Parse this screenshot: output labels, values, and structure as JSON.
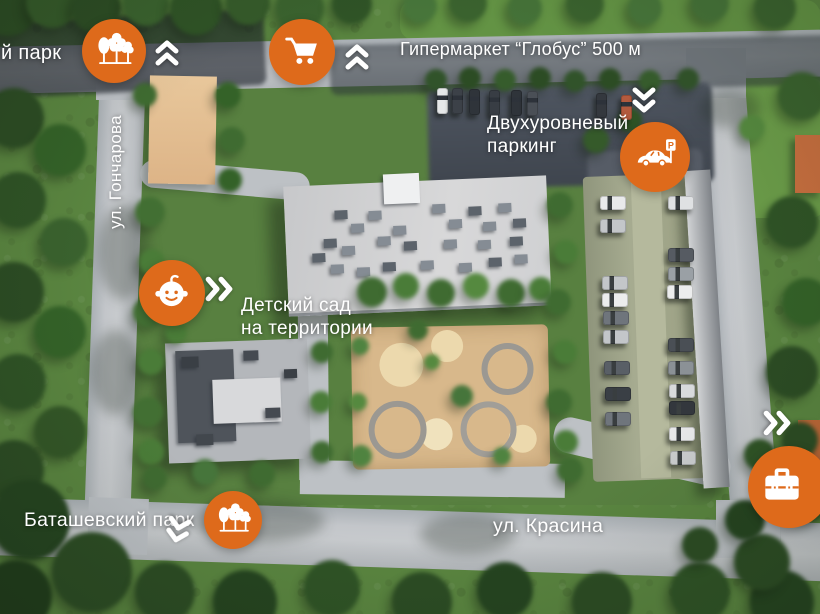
{
  "labels": {
    "park_top": "й парк",
    "hypermarket": "Гипермаркет “Глобус” 500 м",
    "parking_l1": "Двухуровневый",
    "parking_l2": "паркинг",
    "kindergarten_l1": "Детский сад",
    "kindergarten_l2": "на территории",
    "park_bottom": "Баташевский парк",
    "street_bottom": "ул. Красина",
    "street_left": "ул. Гончарова",
    "parking_sign_letter": "P"
  },
  "icons": {
    "park_top": "trees-icon",
    "hypermarket": "shopping-cart-icon",
    "parking": "car-parking-icon",
    "kindergarten": "baby-icon",
    "park_bottom": "trees-icon",
    "business": "briefcase-icon"
  },
  "colors": {
    "poi_badge": "#de6a1b",
    "label_text": "#ffffff"
  }
}
